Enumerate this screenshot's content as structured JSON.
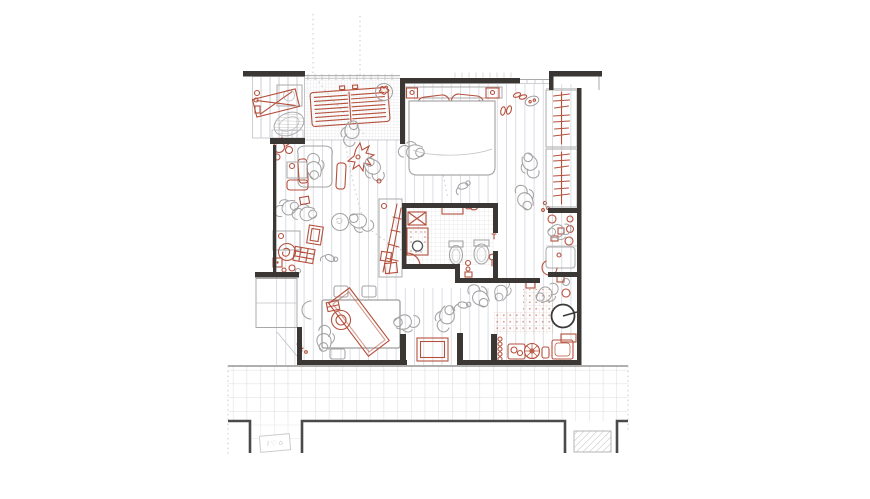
{
  "title": "apartment floor plan drawing",
  "canvas": {
    "width": 870,
    "height": 499
  },
  "colors": {
    "paper": "#ffffff",
    "wall": "#3b3734",
    "red": "#b5503c",
    "fig": "#a3a3a3",
    "plank": "#dcdde4",
    "grid": "#d6d6db",
    "pave": "#dcdcdc",
    "thin": "#a8a8a8",
    "sign": "#c2c2c2"
  },
  "sign": {
    "text": "I ♡ ⌂"
  },
  "rooms": [
    {
      "id": "laundry",
      "label": "laundry"
    },
    {
      "id": "terrace",
      "label": "terrace"
    },
    {
      "id": "bedroom",
      "label": "bedroom"
    },
    {
      "id": "wardrobe",
      "label": "wardrobe"
    },
    {
      "id": "living-room",
      "label": "living room"
    },
    {
      "id": "bathroom",
      "label": "bathroom"
    },
    {
      "id": "dining-area",
      "label": "dining area"
    },
    {
      "id": "kitchen",
      "label": "kitchen"
    },
    {
      "id": "entrance",
      "label": "entrance"
    },
    {
      "id": "walkway",
      "label": "exterior walkway"
    }
  ]
}
